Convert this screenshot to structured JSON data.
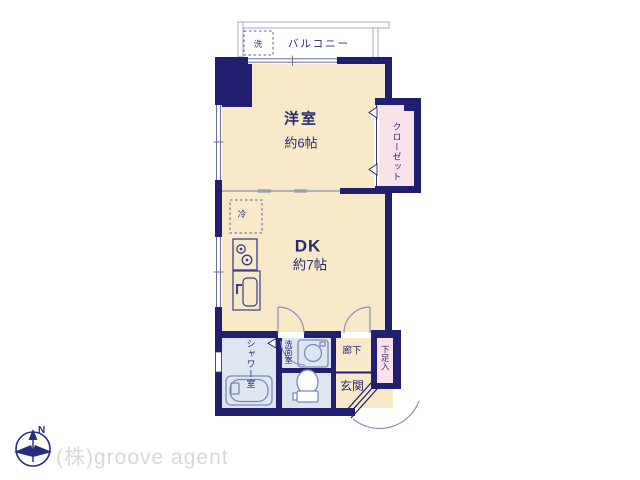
{
  "plan_title": "1DK floor plan",
  "rooms": {
    "balcony": {
      "label": "バルコニー",
      "washer_label": "洗"
    },
    "western_room": {
      "label": "洋室",
      "size": "約6帖"
    },
    "closet": {
      "label": "クローゼット"
    },
    "dk": {
      "label": "DK",
      "size": "約7帖",
      "fridge_label": "冷"
    },
    "shower": {
      "label": "シャワー室"
    },
    "washroom": {
      "label": "洗面室"
    },
    "hallway": {
      "label": "廊下"
    },
    "entrance": {
      "label": "玄関"
    },
    "shoe_box": {
      "label": "下足入"
    }
  },
  "compass": {
    "north_label": "N"
  },
  "watermark": {
    "text": "(株)groove agent"
  },
  "icons": [
    "north-compass-icon",
    "bathtub-icon",
    "toilet-icon",
    "washbasin-icon",
    "stove-icon",
    "kitchen-sink-icon",
    "refrigerator-space-box",
    "washer-space-box",
    "door-swing-arc",
    "folding-door-chevron",
    "entrance-door"
  ],
  "colors": {
    "wall_navy": "#221e70",
    "room_cream": "#f8e9c9",
    "closet_pink": "#fae2ea",
    "wet_area_blue": "#dee6f2",
    "fixture_stroke": "#7f88ba",
    "divider_gray": "#a3a9ba",
    "text_navy": "#2a2a72",
    "watermark_gray": "#d8d8d8"
  }
}
